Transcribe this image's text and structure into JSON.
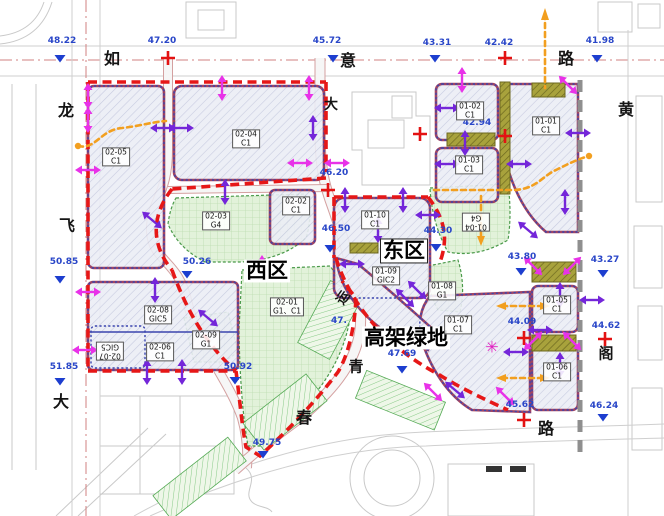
{
  "map_type": "urban-planning-site-plan",
  "regions": {
    "west": {
      "label": "西区",
      "x": 267,
      "y": 271,
      "boxed": false
    },
    "east": {
      "label": "东区",
      "x": 404,
      "y": 251,
      "boxed": true
    },
    "greenway": {
      "label": "高架绿地",
      "x": 406,
      "y": 338,
      "boxed": false
    }
  },
  "road_chars": [
    {
      "ch": "如",
      "x": 112,
      "y": 57,
      "s": 16,
      "rot": 0
    },
    {
      "ch": "意",
      "x": 348,
      "y": 59,
      "s": 16,
      "rot": 0
    },
    {
      "ch": "路",
      "x": 566,
      "y": 57,
      "s": 16,
      "rot": 0
    },
    {
      "ch": "大",
      "x": 331,
      "y": 104,
      "s": 14,
      "rot": 0
    },
    {
      "ch": "黄",
      "x": 626,
      "y": 108,
      "s": 16,
      "rot": 0
    },
    {
      "ch": "阁",
      "x": 606,
      "y": 353,
      "s": 15,
      "rot": 0
    },
    {
      "ch": "龙",
      "x": 66,
      "y": 109,
      "s": 16,
      "rot": 0
    },
    {
      "ch": "飞",
      "x": 67,
      "y": 224,
      "s": 16,
      "rot": 0
    },
    {
      "ch": "大",
      "x": 61,
      "y": 400,
      "s": 16,
      "rot": 0
    },
    {
      "ch": "春",
      "x": 304,
      "y": 416,
      "s": 16,
      "rot": 0
    },
    {
      "ch": "路",
      "x": 546,
      "y": 427,
      "s": 16,
      "rot": 0
    },
    {
      "ch": "青",
      "x": 356,
      "y": 366,
      "s": 15,
      "rot": 0
    },
    {
      "ch": "运",
      "x": 342,
      "y": 297,
      "s": 13,
      "rot": -55
    }
  ],
  "elevations": [
    {
      "v": "48.22",
      "x": 62,
      "y": 41,
      "m": "t",
      "mx": 60,
      "my": 55
    },
    {
      "v": "47.20",
      "x": 162,
      "y": 41,
      "m": "c",
      "mx": 168,
      "my": 58
    },
    {
      "v": "45.72",
      "x": 327,
      "y": 41,
      "m": "t",
      "mx": 333,
      "my": 55
    },
    {
      "v": "43.31",
      "x": 437,
      "y": 43,
      "m": "t",
      "mx": 435,
      "my": 55
    },
    {
      "v": "42.42",
      "x": 499,
      "y": 43,
      "m": "c",
      "mx": 505,
      "my": 58
    },
    {
      "v": "41.98",
      "x": 600,
      "y": 41,
      "m": "t",
      "mx": 597,
      "my": 55
    },
    {
      "v": "42.94",
      "x": 477,
      "y": 123,
      "m": "c",
      "mx": 505,
      "my": 136
    },
    {
      "v": "46.20",
      "x": 334,
      "y": 173,
      "m": "c",
      "mx": 328,
      "my": 190
    },
    {
      "v": "46.50",
      "x": 336,
      "y": 229,
      "m": "t",
      "mx": 330,
      "my": 245
    },
    {
      "v": "44.30",
      "x": 438,
      "y": 231,
      "m": "t",
      "mx": 436,
      "my": 244
    },
    {
      "v": "43.80",
      "x": 522,
      "y": 257,
      "m": "t",
      "mx": 521,
      "my": 268
    },
    {
      "v": "43.27",
      "x": 605,
      "y": 260,
      "m": "t",
      "mx": 603,
      "my": 270
    },
    {
      "v": "44.62",
      "x": 606,
      "y": 326,
      "m": "c",
      "mx": 605,
      "my": 339
    },
    {
      "v": "46.24",
      "x": 604,
      "y": 406,
      "m": "t",
      "mx": 603,
      "my": 414
    },
    {
      "v": "50.85",
      "x": 64,
      "y": 262,
      "m": "t",
      "mx": 60,
      "my": 276
    },
    {
      "v": "51.85",
      "x": 64,
      "y": 367,
      "m": "t",
      "mx": 60,
      "my": 378
    },
    {
      "v": "50.26",
      "x": 197,
      "y": 262,
      "m": "t",
      "mx": 187,
      "my": 271
    },
    {
      "v": "50.92",
      "x": 238,
      "y": 367,
      "m": "t",
      "mx": 235,
      "my": 377
    },
    {
      "v": "49.75",
      "x": 267,
      "y": 443,
      "m": "t",
      "mx": 263,
      "my": 451
    },
    {
      "v": "47.69",
      "x": 402,
      "y": 354,
      "m": "t",
      "mx": 402,
      "my": 366
    },
    {
      "v": "44.09",
      "x": 522,
      "y": 322,
      "m": "c",
      "mx": 524,
      "my": 338
    },
    {
      "v": "45.62",
      "x": 520,
      "y": 405,
      "m": "n",
      "mx": 0,
      "my": 0
    },
    {
      "v": "47.",
      "x": 339,
      "y": 321,
      "m": "n",
      "mx": 0,
      "my": 0
    }
  ],
  "plots": [
    {
      "code": "02-05",
      "use": "C1",
      "x": 116,
      "y": 157,
      "rot": 0
    },
    {
      "code": "02-04",
      "use": "C1",
      "x": 246,
      "y": 139,
      "rot": 0
    },
    {
      "code": "02-03",
      "use": "G4",
      "x": 216,
      "y": 221,
      "rot": 0
    },
    {
      "code": "02-02",
      "use": "C1",
      "x": 296,
      "y": 206,
      "rot": 0
    },
    {
      "code": "02-08",
      "use": "GIC5",
      "x": 158,
      "y": 315,
      "rot": 0
    },
    {
      "code": "02-07",
      "use": "GIC5",
      "x": 110,
      "y": 351,
      "rot": 180
    },
    {
      "code": "02-06",
      "use": "C1",
      "x": 160,
      "y": 352,
      "rot": 0
    },
    {
      "code": "02-09",
      "use": "G1",
      "x": 206,
      "y": 340,
      "rot": 0
    },
    {
      "code": "02-01",
      "use": "G1、C1",
      "x": 287,
      "y": 307,
      "rot": 0
    },
    {
      "code": "01-02",
      "use": "C1",
      "x": 470,
      "y": 111,
      "rot": 0
    },
    {
      "code": "01-03",
      "use": "C1",
      "x": 469,
      "y": 165,
      "rot": 0
    },
    {
      "code": "01-01",
      "use": "C1",
      "x": 546,
      "y": 126,
      "rot": 0
    },
    {
      "code": "01-04",
      "use": "G4",
      "x": 476,
      "y": 222,
      "rot": 180
    },
    {
      "code": "01-10",
      "use": "C1",
      "x": 375,
      "y": 220,
      "rot": 0
    },
    {
      "code": "01-09",
      "use": "GIC2",
      "x": 386,
      "y": 276,
      "rot": 0
    },
    {
      "code": "01-08",
      "use": "G1",
      "x": 442,
      "y": 291,
      "rot": 0
    },
    {
      "code": "01-07",
      "use": "C1",
      "x": 458,
      "y": 325,
      "rot": 0
    },
    {
      "code": "01-05",
      "use": "C1",
      "x": 557,
      "y": 305,
      "rot": 0
    },
    {
      "code": "01-06",
      "use": "C1",
      "x": 557,
      "y": 372,
      "rot": 0
    }
  ],
  "arrows": [
    {
      "x": 88,
      "y": 96,
      "a": 90,
      "c": "m"
    },
    {
      "x": 88,
      "y": 120,
      "a": 90,
      "c": "m"
    },
    {
      "x": 88,
      "y": 170,
      "a": 0,
      "c": "m"
    },
    {
      "x": 88,
      "y": 292,
      "a": 0,
      "c": "m"
    },
    {
      "x": 85,
      "y": 350,
      "a": 0,
      "c": "m"
    },
    {
      "x": 222,
      "y": 88,
      "a": 90,
      "c": "m"
    },
    {
      "x": 309,
      "y": 88,
      "a": 90,
      "c": "m"
    },
    {
      "x": 262,
      "y": 268,
      "a": 90,
      "c": "m"
    },
    {
      "x": 300,
      "y": 163,
      "a": 0,
      "c": "m"
    },
    {
      "x": 337,
      "y": 163,
      "a": 0,
      "c": "m"
    },
    {
      "x": 462,
      "y": 80,
      "a": 90,
      "c": "m"
    },
    {
      "x": 568,
      "y": 85,
      "a": 45,
      "c": "m"
    },
    {
      "x": 533,
      "y": 266,
      "a": 45,
      "c": "m"
    },
    {
      "x": 572,
      "y": 266,
      "a": 135,
      "c": "m"
    },
    {
      "x": 533,
      "y": 341,
      "a": 135,
      "c": "m"
    },
    {
      "x": 572,
      "y": 341,
      "a": 45,
      "c": "m"
    },
    {
      "x": 433,
      "y": 392,
      "a": 45,
      "c": "m"
    },
    {
      "x": 505,
      "y": 396,
      "a": 45,
      "c": "m"
    },
    {
      "x": 163,
      "y": 128,
      "a": 0,
      "c": "p"
    },
    {
      "x": 181,
      "y": 128,
      "a": 0,
      "c": "p"
    },
    {
      "x": 313,
      "y": 128,
      "a": 90,
      "c": "p"
    },
    {
      "x": 225,
      "y": 192,
      "a": 90,
      "c": "p"
    },
    {
      "x": 152,
      "y": 220,
      "a": 40,
      "c": "p"
    },
    {
      "x": 155,
      "y": 290,
      "a": 90,
      "c": "p"
    },
    {
      "x": 147,
      "y": 372,
      "a": 90,
      "c": "p"
    },
    {
      "x": 182,
      "y": 372,
      "a": 90,
      "c": "p"
    },
    {
      "x": 208,
      "y": 318,
      "a": 40,
      "c": "p"
    },
    {
      "x": 345,
      "y": 200,
      "a": 90,
      "c": "p"
    },
    {
      "x": 403,
      "y": 200,
      "a": 90,
      "c": "p"
    },
    {
      "x": 428,
      "y": 215,
      "a": 0,
      "c": "p"
    },
    {
      "x": 378,
      "y": 230,
      "a": 90,
      "c": "p"
    },
    {
      "x": 352,
      "y": 264,
      "a": 0,
      "c": "p"
    },
    {
      "x": 447,
      "y": 108,
      "a": 0,
      "c": "p"
    },
    {
      "x": 447,
      "y": 164,
      "a": 0,
      "c": "p"
    },
    {
      "x": 519,
      "y": 164,
      "a": 0,
      "c": "p"
    },
    {
      "x": 578,
      "y": 133,
      "a": 0,
      "c": "p"
    },
    {
      "x": 465,
      "y": 143,
      "a": 90,
      "c": "p"
    },
    {
      "x": 565,
      "y": 202,
      "a": 90,
      "c": "p"
    },
    {
      "x": 417,
      "y": 290,
      "a": 45,
      "c": "p"
    },
    {
      "x": 405,
      "y": 298,
      "a": 45,
      "c": "p"
    },
    {
      "x": 528,
      "y": 230,
      "a": 40,
      "c": "p"
    },
    {
      "x": 560,
      "y": 295,
      "a": 90,
      "c": "p"
    },
    {
      "x": 560,
      "y": 365,
      "a": 90,
      "c": "p"
    },
    {
      "x": 540,
      "y": 330,
      "a": 0,
      "c": "p"
    },
    {
      "x": 592,
      "y": 300,
      "a": 0,
      "c": "p"
    },
    {
      "x": 516,
      "y": 352,
      "a": 0,
      "c": "p"
    },
    {
      "x": 455,
      "y": 390,
      "a": 40,
      "c": "p"
    }
  ],
  "markers": {
    "crosses": [
      [
        420,
        134
      ],
      [
        524,
        420
      ]
    ]
  },
  "decorations": {
    "asterisk": {
      "char": "✳",
      "x": 492,
      "y": 347,
      "color": "#e020c0"
    }
  },
  "colors": {
    "boundary_red": "#e61717",
    "arrow_purple": "#7426d9",
    "arrow_magenta": "#e832e8",
    "elevation_blue": "#2946c8",
    "survey_triangle_blue": "#1d3ecf",
    "cross_red": "#e31212",
    "bridge_olive": "#a8a23c",
    "green_space": "#e2f2da",
    "plot_fill": "#eceef6",
    "orange_route": "#f29f1f",
    "median_gray": "#8f8f8f"
  }
}
